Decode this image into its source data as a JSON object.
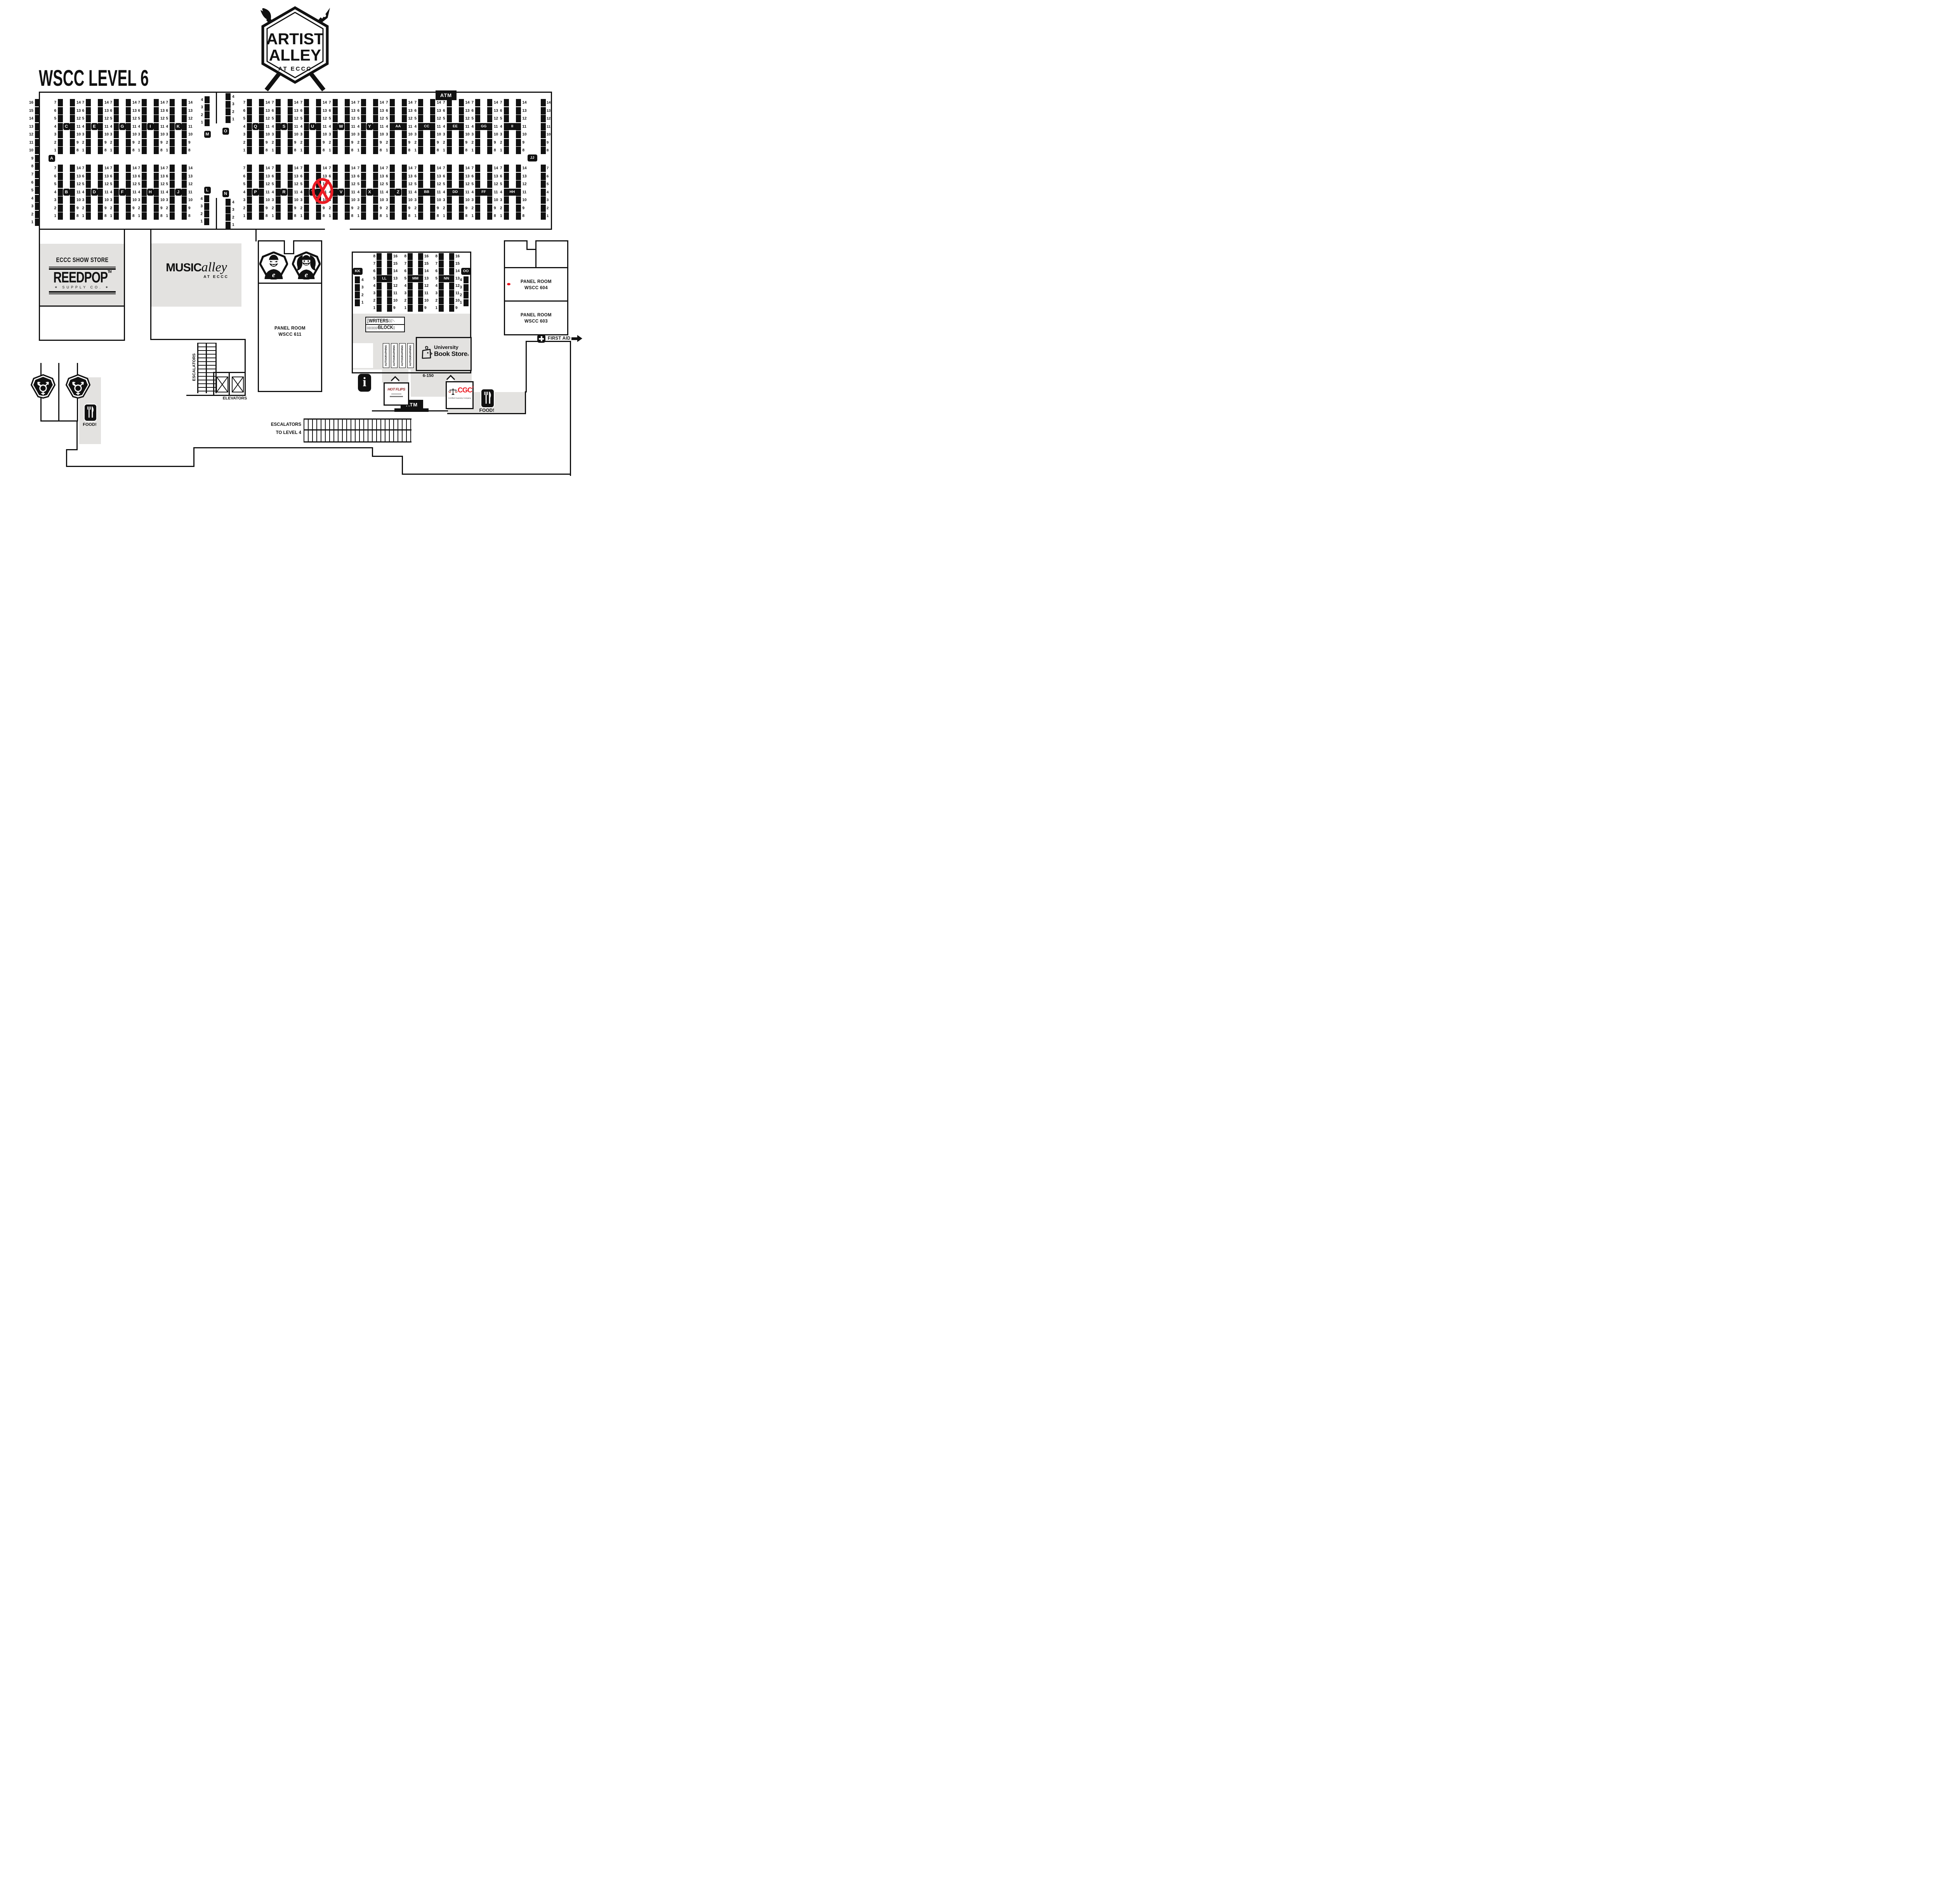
{
  "title": "WSCC LEVEL 6",
  "logo": {
    "line1": "ARTIST",
    "line2": "ALLEY",
    "subtitle": "AT ECCC"
  },
  "amenities": {
    "atm_top": "ATM",
    "atm_bottom": "ATM",
    "food_left": "FOOD!",
    "food_right": "FOOD!",
    "first_aid": "FIRST AID",
    "escalators": "ESCALATORS",
    "elevators": "ELEVATORS",
    "escalators_level4_line1": "ESCALATORS",
    "escalators_level4_line2": "TO LEVEL 4"
  },
  "panel_rooms": {
    "p611_line1": "PANEL ROOM",
    "p611_line2": "WSCC 611",
    "p604_line1": "PANEL ROOM",
    "p604_line2": "WSCC 604",
    "p603_line1": "PANEL ROOM",
    "p603_line2": "WSCC 603"
  },
  "show_store": {
    "title": "ECCC SHOW STORE",
    "brand": "REEDPOP",
    "tm": "TM",
    "sub": "SUPPLY CO."
  },
  "music_alley": {
    "word1": "MUSIC",
    "word2": "alley",
    "sub": "AT ECCC"
  },
  "writers_block": {
    "eccc": "ECCC",
    "word1": "WRITERS",
    "word2": "BLOCK"
  },
  "book_store": {
    "line1": "University",
    "line2": "Book Store",
    "reg": "®"
  },
  "autographing": [
    "AUTOGRAPHING",
    "AUTOGRAPHING",
    "AUTOGRAPHING",
    "AUTOGRAPHING"
  ],
  "vendors": {
    "hot_flips": "HOT FLIPS",
    "cgc": "CGC",
    "cgc_sub": "Certified Guaranty Company",
    "cgc_reg": "®",
    "booth": "6-150"
  },
  "markers": {
    "crossed_out": {
      "section": "T",
      "style": "red circled X"
    },
    "red_dot_room": "WSCC 604"
  },
  "colors": {
    "ink": "#111111",
    "room_gray": "#e3e2e0",
    "accent_red": "#ec1c24"
  },
  "sections": [
    {
      "letter": "A",
      "numbers": [
        16,
        15,
        14,
        13,
        12,
        11,
        10,
        9,
        8,
        7,
        6,
        5,
        4,
        3,
        2,
        1
      ]
    },
    {
      "letter": "C",
      "left": [
        7,
        6,
        5,
        4,
        3,
        2,
        1
      ],
      "right": [
        14,
        13,
        12,
        11,
        10,
        9,
        8
      ]
    },
    {
      "letter": "E",
      "left": [
        7,
        6,
        5,
        4,
        3,
        2,
        1
      ],
      "right": [
        14,
        13,
        12,
        11,
        10,
        9,
        8
      ]
    },
    {
      "letter": "G",
      "left": [
        7,
        6,
        5,
        4,
        3,
        2,
        1
      ],
      "right": [
        14,
        13,
        12,
        11,
        10,
        9,
        8
      ]
    },
    {
      "letter": "I",
      "left": [
        7,
        6,
        5,
        4,
        3,
        2,
        1
      ],
      "right": [
        14,
        13,
        12,
        11,
        10,
        9,
        8
      ]
    },
    {
      "letter": "K",
      "left": [
        7,
        6,
        5,
        4,
        3,
        2,
        1
      ],
      "right": [
        14,
        13,
        12,
        11,
        10,
        9,
        8
      ]
    },
    {
      "letter": "B",
      "left": [
        7,
        6,
        5,
        4,
        3,
        2,
        1
      ],
      "right": [
        14,
        13,
        12,
        11,
        10,
        9,
        8
      ]
    },
    {
      "letter": "D",
      "left": [
        7,
        6,
        5,
        4,
        3,
        2,
        1
      ],
      "right": [
        14,
        13,
        12,
        11,
        10,
        9,
        8
      ]
    },
    {
      "letter": "F",
      "left": [
        7,
        6,
        5,
        4,
        3,
        2,
        1
      ],
      "right": [
        14,
        13,
        12,
        11,
        10,
        9,
        8
      ]
    },
    {
      "letter": "H",
      "left": [
        7,
        6,
        5,
        4,
        3,
        2,
        1
      ],
      "right": [
        14,
        13,
        12,
        11,
        10,
        9,
        8
      ]
    },
    {
      "letter": "J",
      "left": [
        7,
        6,
        5,
        4,
        3,
        2,
        1
      ],
      "right": [
        14,
        13,
        12,
        11,
        10,
        9,
        8
      ]
    },
    {
      "letter": "M",
      "numbers": [
        4,
        3,
        2,
        1
      ]
    },
    {
      "letter": "O",
      "numbers": [
        4,
        3,
        2,
        1
      ]
    },
    {
      "letter": "L",
      "numbers": [
        4,
        3,
        2,
        1
      ]
    },
    {
      "letter": "N",
      "numbers": [
        4,
        3,
        2,
        1
      ]
    },
    {
      "letter": "Q",
      "left": [
        7,
        6,
        5,
        4,
        3,
        2,
        1
      ],
      "right": [
        14,
        13,
        12,
        11,
        10,
        9,
        8
      ]
    },
    {
      "letter": "S",
      "left": [
        7,
        6,
        5,
        4,
        3,
        2,
        1
      ],
      "right": [
        14,
        13,
        12,
        11,
        10,
        9,
        8
      ]
    },
    {
      "letter": "U",
      "left": [
        7,
        6,
        5,
        4,
        3,
        2,
        1
      ],
      "right": [
        14,
        13,
        12,
        11,
        10,
        9,
        8
      ]
    },
    {
      "letter": "W",
      "left": [
        7,
        6,
        5,
        4,
        3,
        2,
        1
      ],
      "right": [
        14,
        13,
        12,
        11,
        10,
        9,
        8
      ]
    },
    {
      "letter": "Y",
      "left": [
        7,
        6,
        5,
        4,
        3,
        2,
        1
      ],
      "right": [
        14,
        13,
        12,
        11,
        10,
        9,
        8
      ]
    },
    {
      "letter": "AA",
      "left": [
        7,
        6,
        5,
        4,
        3,
        2,
        1
      ],
      "right": [
        14,
        13,
        12,
        11,
        10,
        9,
        8
      ]
    },
    {
      "letter": "CC",
      "left": [
        7,
        6,
        5,
        4,
        3,
        2,
        1
      ],
      "right": [
        14,
        13,
        12,
        11,
        10,
        9,
        8
      ]
    },
    {
      "letter": "EE",
      "left": [
        7,
        6,
        5,
        4,
        3,
        2,
        1
      ],
      "right": [
        14,
        13,
        12,
        11,
        10,
        9,
        8
      ]
    },
    {
      "letter": "GG",
      "left": [
        7,
        6,
        5,
        4,
        3,
        2,
        1
      ],
      "right": [
        14,
        13,
        12,
        11,
        10,
        9,
        8
      ]
    },
    {
      "letter": "II",
      "left": [
        7,
        6,
        5,
        4,
        3,
        2,
        1
      ],
      "right": [
        14,
        13,
        12,
        11,
        10,
        9,
        8
      ]
    },
    {
      "letter": "JJ",
      "upper": [
        14,
        13,
        12,
        11,
        10,
        9,
        8
      ],
      "lower": [
        7,
        6,
        5,
        4,
        3,
        2,
        1
      ]
    },
    {
      "letter": "P",
      "left": [
        7,
        6,
        5,
        4,
        3,
        2,
        1
      ],
      "right": [
        14,
        13,
        12,
        11,
        10,
        9,
        8
      ]
    },
    {
      "letter": "R",
      "left": [
        7,
        6,
        5,
        4,
        3,
        2,
        1
      ],
      "right": [
        14,
        13,
        12,
        11,
        10,
        9,
        8
      ]
    },
    {
      "letter": "T",
      "left": [
        7,
        6,
        5,
        4,
        3,
        2,
        1
      ],
      "right": [
        14,
        13,
        12,
        11,
        10,
        9,
        8
      ]
    },
    {
      "letter": "V",
      "left": [
        7,
        6,
        5,
        4,
        3,
        2,
        1
      ],
      "right": [
        14,
        13,
        12,
        11,
        10,
        9,
        8
      ]
    },
    {
      "letter": "X",
      "left": [
        7,
        6,
        5,
        4,
        3,
        2,
        1
      ],
      "right": [
        14,
        13,
        12,
        11,
        10,
        9,
        8
      ]
    },
    {
      "letter": "Z",
      "left": [
        7,
        6,
        5,
        4,
        3,
        2,
        1
      ],
      "right": [
        14,
        13,
        12,
        11,
        10,
        9,
        8
      ]
    },
    {
      "letter": "BB",
      "left": [
        7,
        6,
        5,
        4,
        3,
        2,
        1
      ],
      "right": [
        14,
        13,
        12,
        11,
        10,
        9,
        8
      ]
    },
    {
      "letter": "DD",
      "left": [
        7,
        6,
        5,
        4,
        3,
        2,
        1
      ],
      "right": [
        14,
        13,
        12,
        11,
        10,
        9,
        8
      ]
    },
    {
      "letter": "FF",
      "left": [
        7,
        6,
        5,
        4,
        3,
        2,
        1
      ],
      "right": [
        14,
        13,
        12,
        11,
        10,
        9,
        8
      ]
    },
    {
      "letter": "HH",
      "left": [
        7,
        6,
        5,
        4,
        3,
        2,
        1
      ],
      "right": [
        14,
        13,
        12,
        11,
        10,
        9,
        8
      ]
    },
    {
      "letter": "KK",
      "numbers": [
        4,
        3,
        2,
        1
      ]
    },
    {
      "letter": "LL",
      "left": [
        8,
        7,
        6,
        5,
        4,
        3,
        2,
        1
      ],
      "right": [
        16,
        15,
        14,
        13,
        12,
        11,
        10,
        9
      ]
    },
    {
      "letter": "MM",
      "left": [
        8,
        7,
        6,
        5,
        4,
        3,
        2,
        1
      ],
      "right": [
        16,
        15,
        14,
        13,
        12,
        11,
        10,
        9
      ]
    },
    {
      "letter": "NN",
      "left": [
        8,
        7,
        6,
        5,
        4,
        3,
        2,
        1
      ],
      "right": [
        16,
        15,
        14,
        13,
        12,
        11,
        10,
        9
      ]
    },
    {
      "letter": "OO",
      "numbers": [
        4,
        3,
        2,
        1
      ]
    }
  ]
}
